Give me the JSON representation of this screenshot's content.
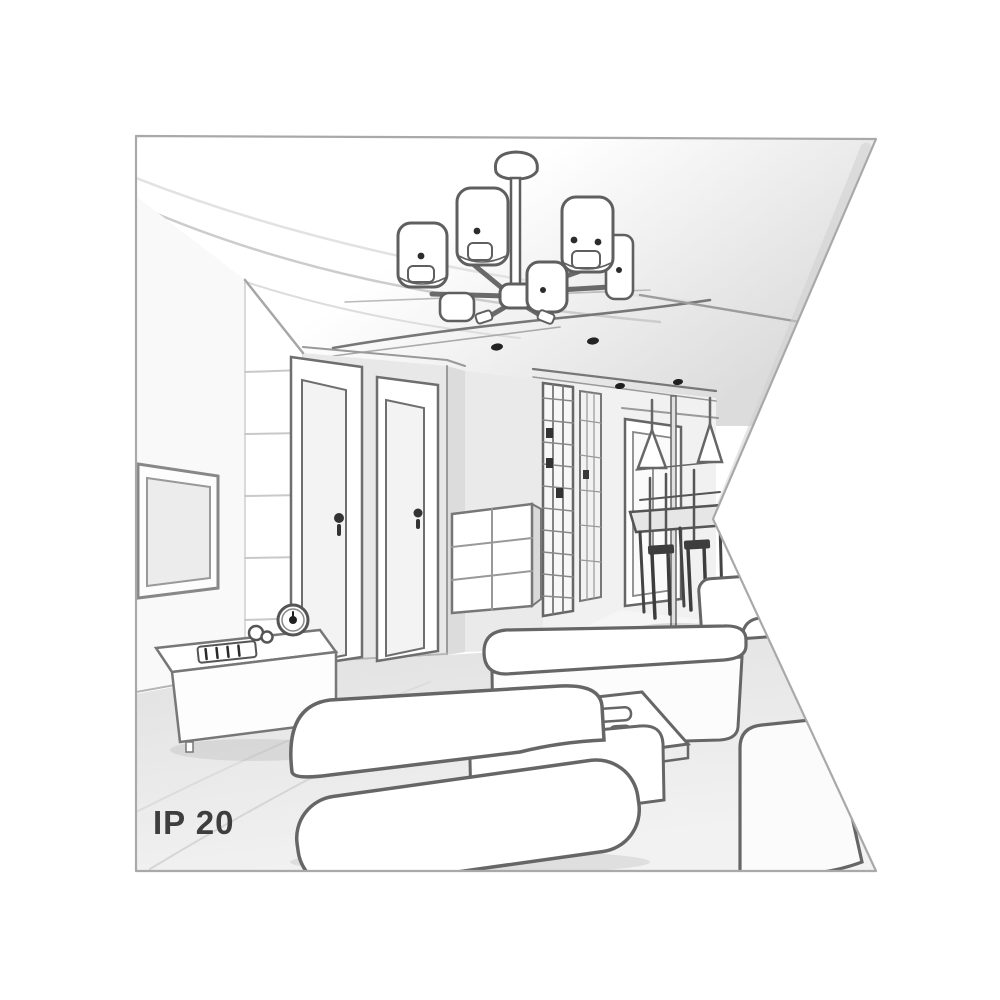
{
  "scene": {
    "ip_rating": "IP 20",
    "type_label": "interior line-art illustration",
    "room": "living room with hallway and dining nook, one-point perspective sketch",
    "objects": [
      "six-shade drum chandelier on dropped ceiling panel",
      "recessed ceiling spotlights",
      "wall-mounted TV",
      "TV console with alarm clock, figurine and remote control",
      "two interior doors with handles",
      "slatted wall panel",
      "chest of drawers",
      "wardrobe with grid doors",
      "hallway window",
      "two cone pendant lamps",
      "dining table with chairs",
      "corner sofa",
      "ottoman",
      "coffee table with tray and cups"
    ],
    "colors": {
      "background": "#ffffff",
      "outline": "#666666",
      "outline_dark": "#2c2c2c",
      "wall_light": "#efefef",
      "wall_mid": "#e3e3e3",
      "floor": "#e9e9e9",
      "frame_border": "#a9a9a9",
      "label_text": "#3e3e3e"
    }
  }
}
